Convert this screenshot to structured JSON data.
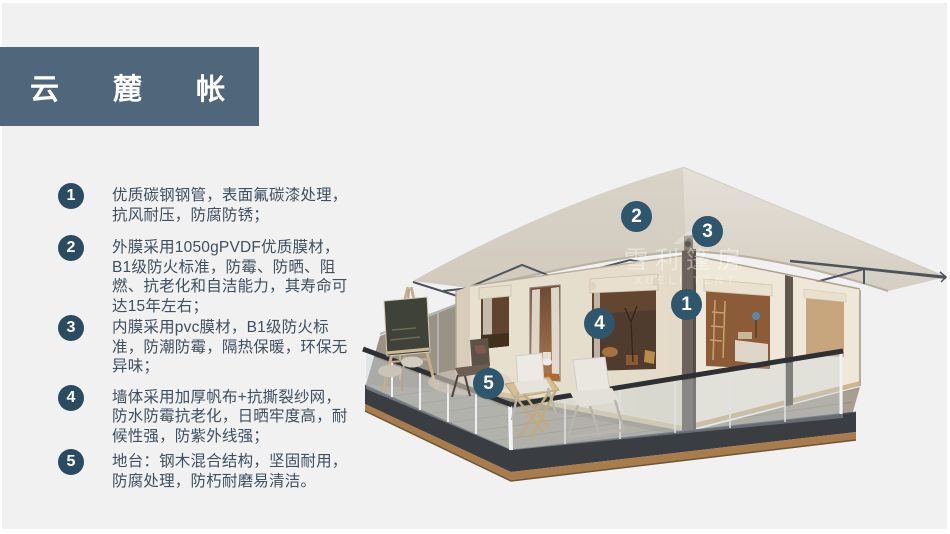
{
  "slide": {
    "title": "云 麓 帐 篷",
    "colors": {
      "background": "#f1f1f2",
      "banner": "#50677b",
      "list_badge": "#2b4b61",
      "marker_badge": "#2e566c",
      "body_text": "#3e4f5f"
    }
  },
  "features": [
    {
      "num": "1",
      "text": "优质碳钢钢管，表面氟碳漆处理，抗风耐压，防腐防锈；"
    },
    {
      "num": "2",
      "text": "外膜采用1050gPVDF优质膜材，B1级防火标准，防霉、防晒、阻燃、抗老化和自洁能力，其寿命可达15年左右；"
    },
    {
      "num": "3",
      "text": "内膜采用pvc膜材，B1级防火标准，防潮防霉，隔热保暖，环保无异味；"
    },
    {
      "num": "4",
      "text": "墙体采用加厚帆布+抗撕裂纱网，防水防霉抗老化，日晒牢度高，耐候性强，防紫外线强；"
    },
    {
      "num": "5",
      "text": "地台：钢木混合结构，坚固耐用，防腐处理，防朽耐磨易清洁。"
    }
  ],
  "markers": [
    {
      "label": "1"
    },
    {
      "label": "2"
    },
    {
      "label": "3"
    },
    {
      "label": "4"
    },
    {
      "label": "5"
    }
  ],
  "watermark": {
    "cn": "雪利篷房",
    "en": "XUELI TENT"
  }
}
